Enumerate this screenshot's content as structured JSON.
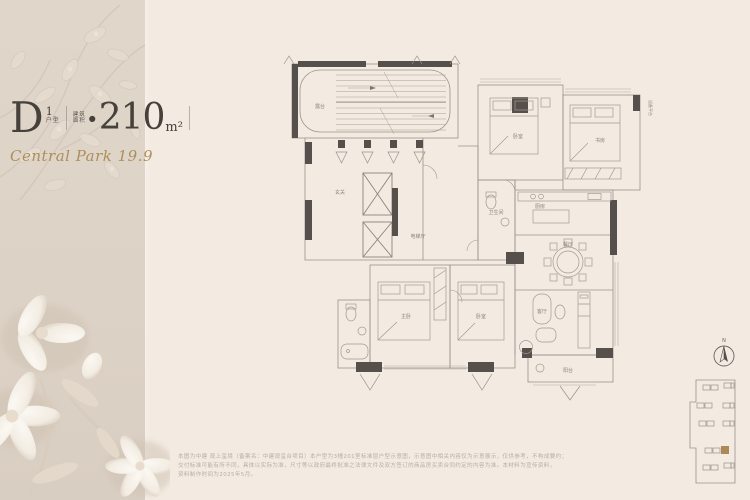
{
  "colors": {
    "page_background": "#f3eae2",
    "sidebar_background": "#ddd2c6",
    "accent_gold": "#ad8f5c",
    "ink": "#46413b",
    "wall": "#55504b",
    "site_highlight": "#ad8a55"
  },
  "header": {
    "unit_letter": "D",
    "unit_number": "1",
    "unit_label": "户型",
    "area_label_top": "建筑",
    "area_label_bottom": "面积",
    "bullet": "●",
    "area_value": "210",
    "area_unit": "m²",
    "tagline": "Central Park 19.9"
  },
  "floorplan": {
    "labels": [
      "露台",
      "玄关",
      "电梯厅",
      "卧室",
      "书房",
      "卫生间",
      "厨房",
      "餐厅",
      "客厅",
      "主卧",
      "卧室",
      "阳台",
      "设备平台"
    ]
  },
  "compass": {
    "north_label": "N"
  },
  "site_plan": {
    "highlight_color": "#ad8a55"
  },
  "disclaimer": {
    "lines": [
      "本图为中建 观上玺境（备案名：中建观玺台项目）本户型为3幢201室标准层户型示意图，示意图中相关内容仅为示意展示，仅供参考，不构成要约；",
      "交付标准可能有所不同，具体以实际为准，尺寸等以政府最终批准之法律文件及双方签订的商品房买卖合同约定的内容为准。本材料为宣传资料，",
      "资料制作时间为2025年5月。"
    ]
  }
}
